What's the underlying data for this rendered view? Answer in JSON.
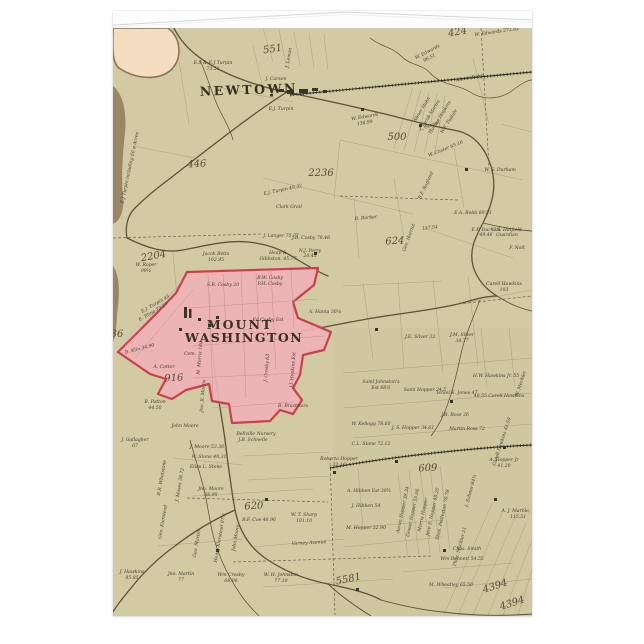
{
  "colors": {
    "page_bg": "#ffffff",
    "card_bg": "#fdfdfd",
    "fold_line": "#d6d6d6",
    "map_bg": "#d1caa3",
    "map_tint": "#c9c29b",
    "pond": "#f4dcc1",
    "terrain": "#8a7456",
    "road": "#5e5238",
    "rail": "#2f2a20",
    "creek": "#564a30",
    "parcel_line": "#8f8566",
    "boundary": "#5c5140",
    "pink_fill": "#efb2b6",
    "pink_border": "#c8404e",
    "pink_line": "#b9868c",
    "ink": "#453c2d",
    "num_ink": "#554b37",
    "town_ink": "#37301f",
    "house": "#3a3426"
  },
  "map": {
    "town_labels": [
      {
        "t": "NEWTOWN",
        "x": 136,
        "y": 66,
        "s": 13,
        "ls": 2.5,
        "r": -2
      },
      {
        "t": "MOUNT",
        "x": 127,
        "y": 301,
        "s": 11,
        "ls": 2
      },
      {
        "t": "WASHINGTON",
        "x": 131,
        "y": 314,
        "s": 11,
        "ls": 1.5
      }
    ],
    "district_numbers": [
      {
        "t": "424",
        "x": 345,
        "y": 7,
        "r": -10,
        "s": 9
      },
      {
        "t": "551",
        "x": 160,
        "y": 24,
        "r": -8,
        "s": 9.5
      },
      {
        "t": "446",
        "x": 84,
        "y": 139,
        "r": -3,
        "s": 10.5
      },
      {
        "t": "500",
        "x": 284,
        "y": 112,
        "s": 10.5
      },
      {
        "t": "2236",
        "x": 208,
        "y": 148,
        "s": 10
      },
      {
        "t": "2204",
        "x": 41,
        "y": 231,
        "r": -10,
        "s": 11
      },
      {
        "t": "624",
        "x": 282,
        "y": 216,
        "r": -3,
        "s": 10
      },
      {
        "t": "916",
        "x": 61,
        "y": 353,
        "r": -3,
        "s": 11
      },
      {
        "t": "620",
        "x": 141,
        "y": 481,
        "r": -3,
        "s": 10
      },
      {
        "t": "609",
        "x": 315,
        "y": 443,
        "r": -3,
        "s": 10
      },
      {
        "t": "5581",
        "x": 236,
        "y": 554,
        "r": -12,
        "s": 10
      },
      {
        "t": "4394",
        "x": 383,
        "y": 561,
        "r": -18,
        "s": 10
      },
      {
        "t": "4394",
        "x": 400,
        "y": 578,
        "r": -18,
        "s": 9
      },
      {
        "t": "36",
        "x": 4,
        "y": 309,
        "s": 9
      }
    ],
    "parcels": [
      {
        "t": "E.S & E.J Turpin",
        "x": 100,
        "y": 36
      },
      {
        "t": "73.51",
        "x": 100,
        "y": 42
      },
      {
        "t": "J. Lemon",
        "x": 177,
        "y": 30,
        "r": -80
      },
      {
        "t": "J. Carson",
        "x": 163,
        "y": 52
      },
      {
        "t": "W. Edwards 272.82",
        "x": 384,
        "y": 5,
        "r": -8
      },
      {
        "t": "W. Edwards",
        "x": 315,
        "y": 25,
        "r": -28
      },
      {
        "t": "96.51",
        "x": 317,
        "y": 31,
        "r": -28
      },
      {
        "t": "Abner Kahn",
        "x": 357,
        "y": 51,
        "r": -10
      },
      {
        "t": "W. Edwards",
        "x": 252,
        "y": 90,
        "r": -10
      },
      {
        "t": "138.99",
        "x": 252,
        "y": 96,
        "r": -10
      },
      {
        "t": "E.J. Turpin",
        "x": 168,
        "y": 82
      },
      {
        "t": "Abner Hahn",
        "x": 310,
        "y": 82,
        "r": -58
      },
      {
        "t": "Jacob Martin",
        "x": 319,
        "y": 86,
        "r": -58
      },
      {
        "t": "Horace Hopkins",
        "x": 328,
        "y": 90,
        "r": -58
      },
      {
        "t": "W.F. Tisdale",
        "x": 337,
        "y": 94,
        "r": -58
      },
      {
        "t": "L. Moran",
        "x": 317,
        "y": 99,
        "r": -20
      },
      {
        "t": "W. Custer 65.16",
        "x": 333,
        "y": 122,
        "r": -22
      },
      {
        "t": "B.F. Ragland",
        "x": 314,
        "y": 158,
        "r": -65
      },
      {
        "t": "W. S. Durham",
        "x": 387,
        "y": 143
      },
      {
        "t": "E.J. Turpin 49.32",
        "x": 170,
        "y": 163,
        "r": -12
      },
      {
        "t": "Clark Grail",
        "x": 176,
        "y": 180
      },
      {
        "t": "J. Langer 75.77",
        "x": 168,
        "y": 209
      },
      {
        "t": "J.B. Cosby 78.46",
        "x": 198,
        "y": 211
      },
      {
        "t": "E.A. Robb 69.51",
        "x": 360,
        "y": 186
      },
      {
        "t": "E.F. Durham",
        "x": 373,
        "y": 203
      },
      {
        "t": "49.46",
        "x": 373,
        "y": 208
      },
      {
        "t": "C.S. Hatfield",
        "x": 394,
        "y": 203
      },
      {
        "t": "Guardian",
        "x": 394,
        "y": 208
      },
      {
        "t": "F. Nolt",
        "x": 404,
        "y": 221
      },
      {
        "t": "B. Barber",
        "x": 253,
        "y": 191,
        "r": -5
      },
      {
        "t": "Geo. Harriot",
        "x": 297,
        "y": 210,
        "r": -70
      },
      {
        "t": "137.54",
        "x": 317,
        "y": 201,
        "r": -5
      },
      {
        "t": "Jacob Betts",
        "x": 103,
        "y": 227
      },
      {
        "t": "102.95",
        "x": 103,
        "y": 233
      },
      {
        "t": "Heap &",
        "x": 165,
        "y": 226
      },
      {
        "t": "Gibbston. 45.77",
        "x": 165,
        "y": 232
      },
      {
        "t": "N.J. Perry",
        "x": 197,
        "y": 224
      },
      {
        "t": "26.45",
        "x": 197,
        "y": 229
      },
      {
        "t": "W. Roper",
        "x": 33,
        "y": 238
      },
      {
        "t": "99½",
        "x": 33,
        "y": 244
      },
      {
        "t": "E J Turpin including 60 a Acres",
        "x": 18,
        "y": 140,
        "r": -78,
        "s": 4
      },
      {
        "t": "Carell Hawkins",
        "x": 391,
        "y": 257
      },
      {
        "t": "103",
        "x": 391,
        "y": 263
      },
      {
        "t": "A. Hanta 30¼",
        "x": 212,
        "y": 285
      },
      {
        "t": "S.B. Cosby 20",
        "x": 110,
        "y": 258
      },
      {
        "t": "B.W. Cosby",
        "x": 157,
        "y": 251
      },
      {
        "t": "P.H. Cosby",
        "x": 157,
        "y": 257
      },
      {
        "t": "Ed Cosby Est",
        "x": 155,
        "y": 293
      },
      {
        "t": "J. Crosby 63",
        "x": 155,
        "y": 340,
        "r": -85
      },
      {
        "t": "J.J. Hopkins Est",
        "x": 181,
        "y": 342,
        "r": -85
      },
      {
        "t": "Jno. R. Morris",
        "x": 91,
        "y": 368,
        "r": -85
      },
      {
        "t": "M. Morris 180",
        "x": 88,
        "y": 330,
        "r": -85
      },
      {
        "t": "Cem.",
        "x": 77,
        "y": 327
      },
      {
        "t": "B. Brashears",
        "x": 180,
        "y": 379
      },
      {
        "t": "E.J. Turpin 45",
        "x": 43,
        "y": 277,
        "r": -30
      },
      {
        "t": "E. Eline 72.27",
        "x": 41,
        "y": 285,
        "r": -30
      },
      {
        "t": "B. Klin 34.90",
        "x": 27,
        "y": 322,
        "r": -15
      },
      {
        "t": "A. Cotter",
        "x": 51,
        "y": 340
      },
      {
        "t": "B. Patton",
        "x": 42,
        "y": 375
      },
      {
        "t": "44.50",
        "x": 42,
        "y": 381
      },
      {
        "t": "John Moore",
        "x": 72,
        "y": 399
      },
      {
        "t": "J. Moore 53.36",
        "x": 94,
        "y": 420
      },
      {
        "t": "W. Stone 48.31",
        "x": 96,
        "y": 430
      },
      {
        "t": "Elias L. Stone",
        "x": 93,
        "y": 440
      },
      {
        "t": "J. Gallagher",
        "x": 22,
        "y": 413
      },
      {
        "t": "67",
        "x": 22,
        "y": 419
      },
      {
        "t": "B.R. Whetstone",
        "x": 50,
        "y": 450,
        "r": -80
      },
      {
        "t": "J. Moses 38.72",
        "x": 68,
        "y": 457,
        "r": -80
      },
      {
        "t": "Jno. Moore",
        "x": 98,
        "y": 462
      },
      {
        "t": "66.95",
        "x": 98,
        "y": 468
      },
      {
        "t": "Bellville Nursery",
        "x": 143,
        "y": 407
      },
      {
        "t": "J.B. Schnelle",
        "x": 140,
        "y": 413
      },
      {
        "t": "J. Hawkins",
        "x": 19,
        "y": 545
      },
      {
        "t": "85.85",
        "x": 19,
        "y": 551
      },
      {
        "t": "Jno. Martin",
        "x": 68,
        "y": 547
      },
      {
        "t": "77",
        "x": 68,
        "y": 553
      },
      {
        "t": "Geo. Kierstead",
        "x": 51,
        "y": 494,
        "r": -80
      },
      {
        "t": "Geo. Martin",
        "x": 85,
        "y": 516,
        "r": -80
      },
      {
        "t": "Henry Kierstead 87½",
        "x": 108,
        "y": 510,
        "r": -80
      },
      {
        "t": "John Moore",
        "x": 124,
        "y": 510,
        "r": -80
      },
      {
        "t": "Wm Crosby",
        "x": 118,
        "y": 548
      },
      {
        "t": "66.06",
        "x": 118,
        "y": 554
      },
      {
        "t": "W. H. Johnston",
        "x": 168,
        "y": 548
      },
      {
        "t": "77.10",
        "x": 168,
        "y": 554
      },
      {
        "t": "B.F. Coe 48.96",
        "x": 146,
        "y": 493
      },
      {
        "t": "W. T. Sharp",
        "x": 191,
        "y": 488
      },
      {
        "t": "101.10",
        "x": 191,
        "y": 494
      },
      {
        "t": "Varney Avenue",
        "x": 196,
        "y": 516,
        "r": -3
      },
      {
        "t": "J.E. Silver 33",
        "x": 307,
        "y": 310
      },
      {
        "t": "J.M. Silver",
        "x": 349,
        "y": 308
      },
      {
        "t": "38.77",
        "x": 349,
        "y": 314
      },
      {
        "t": "Saml Johnston's",
        "x": 268,
        "y": 355
      },
      {
        "t": "Est 68½",
        "x": 268,
        "y": 361
      },
      {
        "t": "Saml Hopper 24.5",
        "x": 312,
        "y": 363
      },
      {
        "t": "Israel E. Jones 47",
        "x": 344,
        "y": 366
      },
      {
        "t": "H.W. Hawkins Jr. 55",
        "x": 383,
        "y": 349
      },
      {
        "t": "48.55 Carell Hawkins",
        "x": 386,
        "y": 369
      },
      {
        "t": "W. Mechler",
        "x": 409,
        "y": 356,
        "r": -72
      },
      {
        "t": "J.B. Rose 26",
        "x": 342,
        "y": 388
      },
      {
        "t": "J. S. Hopper 34.61",
        "x": 300,
        "y": 401
      },
      {
        "t": "Martin Ross 72",
        "x": 354,
        "y": 402
      },
      {
        "t": "Carell Hawkins 45.50",
        "x": 390,
        "y": 414,
        "r": -72
      },
      {
        "t": "W. Kellogg 78.60",
        "x": 258,
        "y": 397
      },
      {
        "t": "C.L. Stone 72.12",
        "x": 258,
        "y": 417
      },
      {
        "t": "Roberta Hopper",
        "x": 226,
        "y": 432
      },
      {
        "t": "32.16",
        "x": 226,
        "y": 438
      },
      {
        "t": "A. Hopper Jr",
        "x": 391,
        "y": 433
      },
      {
        "t": "41.20",
        "x": 391,
        "y": 439
      },
      {
        "t": "Aaron Hopper 38.34",
        "x": 291,
        "y": 482,
        "r": -78
      },
      {
        "t": "Gower Hopper 55.06",
        "x": 301,
        "y": 485,
        "r": -78
      },
      {
        "t": "Morris Hopper",
        "x": 311,
        "y": 487,
        "r": -78
      },
      {
        "t": "Jere S. Hopper 48.20",
        "x": 321,
        "y": 484,
        "r": -78
      },
      {
        "t": "Thos. Pedleston 78.78",
        "x": 331,
        "y": 487,
        "r": -78
      },
      {
        "t": "I. Schnur 64¾",
        "x": 359,
        "y": 463,
        "r": -75
      },
      {
        "t": "Thos. Mackler 51",
        "x": 348,
        "y": 519,
        "r": -75
      },
      {
        "t": "A. J. Marble,",
        "x": 403,
        "y": 484
      },
      {
        "t": "115.51",
        "x": 405,
        "y": 490
      },
      {
        "t": "A. Hibben Est 30¾",
        "x": 256,
        "y": 464
      },
      {
        "t": "J. Hibben 54",
        "x": 253,
        "y": 479
      },
      {
        "t": "M. Hopper 32.90",
        "x": 253,
        "y": 501
      },
      {
        "t": "Chas. Smith",
        "x": 354,
        "y": 522
      },
      {
        "t": "Wm Bennett 54.55",
        "x": 349,
        "y": 532
      },
      {
        "t": "M. Wheatley 65.50",
        "x": 338,
        "y": 558
      }
    ]
  }
}
